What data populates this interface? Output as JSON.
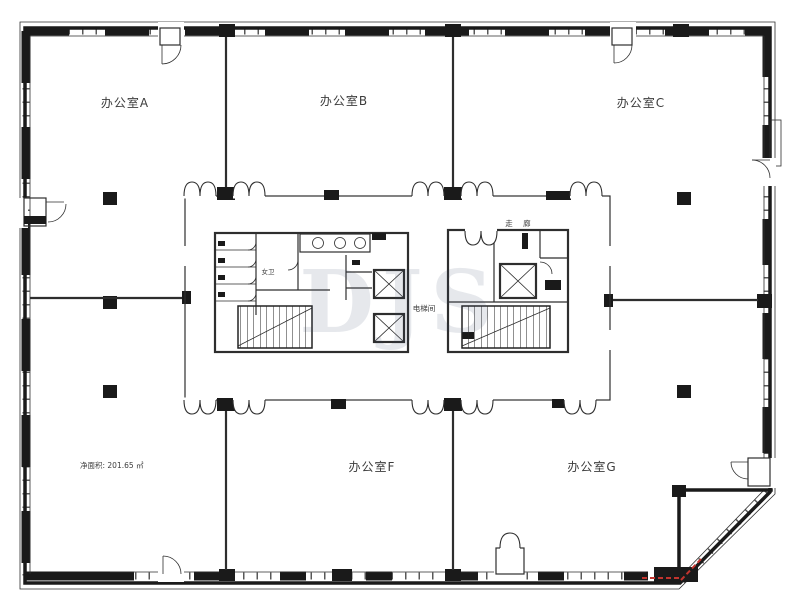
{
  "rooms": {
    "a": "办公室A",
    "b": "办公室B",
    "c": "办公室C",
    "f": "办公室F",
    "g": "办公室G"
  },
  "core_labels": {
    "corridor": "走 廊",
    "elevator_room": "电梯间",
    "womens_restroom": "女卫"
  },
  "annotations": {
    "net_area": "净面积: 201.65 ㎡",
    "watermark": "DJS"
  },
  "colors": {
    "wall": "#1a1a1a",
    "line": "#2e2e2e",
    "label": "#3c3c3c",
    "watermark": "#3b4a6b",
    "red": "#c3342e",
    "paper": "#ffffff"
  }
}
